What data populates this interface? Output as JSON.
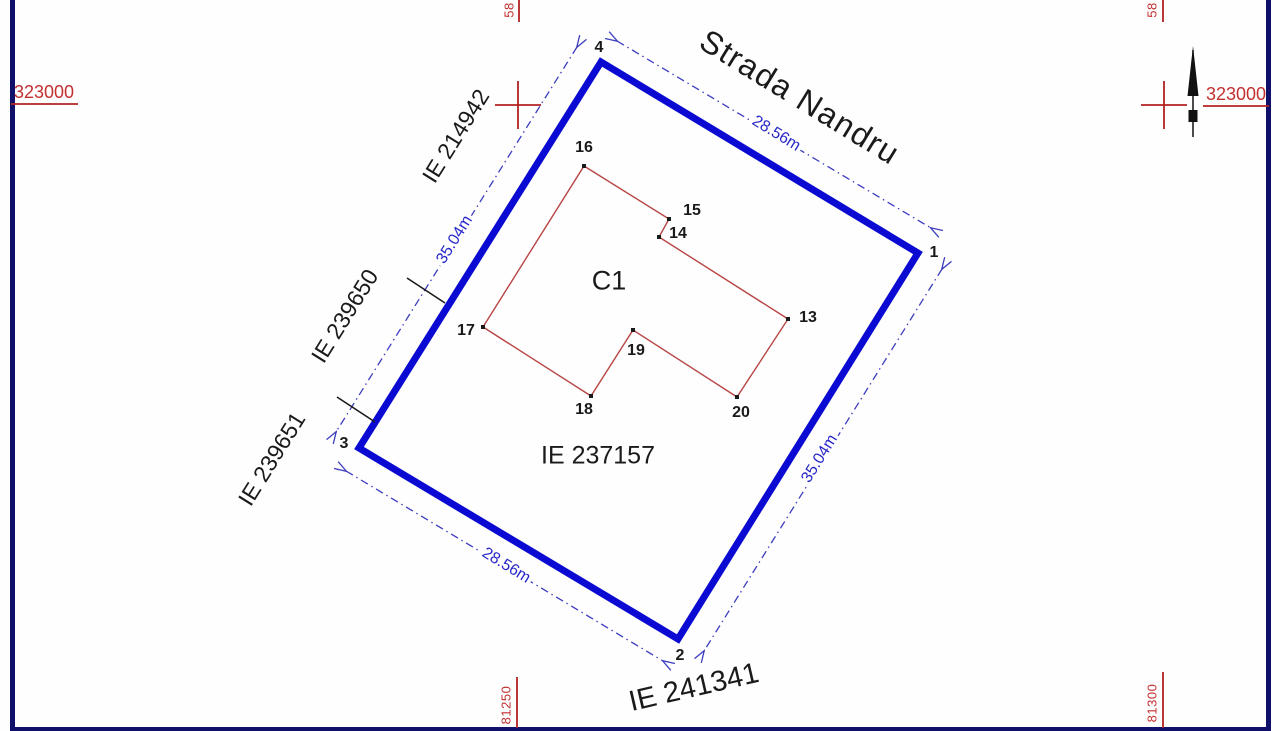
{
  "street": {
    "label": "Strada Nandru"
  },
  "parcel": {
    "id": "IE 237157",
    "building_label": "C1",
    "corners": [
      "1",
      "2",
      "3",
      "4"
    ]
  },
  "building_points": [
    "13",
    "14",
    "15",
    "16",
    "17",
    "18",
    "19",
    "20"
  ],
  "neighbors": {
    "west_top": "IE 214942",
    "west_mid": "IE 239650",
    "west_bottom": "IE 239651",
    "south": "IE 241341"
  },
  "dimensions": {
    "street_side": "28.56m",
    "east_side": "35.04m",
    "south_side": "28.56m",
    "west_side": "35.04m"
  },
  "grid": {
    "northing_left": "323000",
    "northing_right": "323000",
    "easting_top_left": "58",
    "easting_top_right": "58",
    "easting_bottom_left": "81250",
    "easting_bottom_right": "81300"
  },
  "colors": {
    "boundary_blue": "#0a0ad2",
    "dimension_blue": "#3c3cbe",
    "building_red": "#b84444",
    "grid_red": "#b22222",
    "frame_navy": "#10106a"
  }
}
